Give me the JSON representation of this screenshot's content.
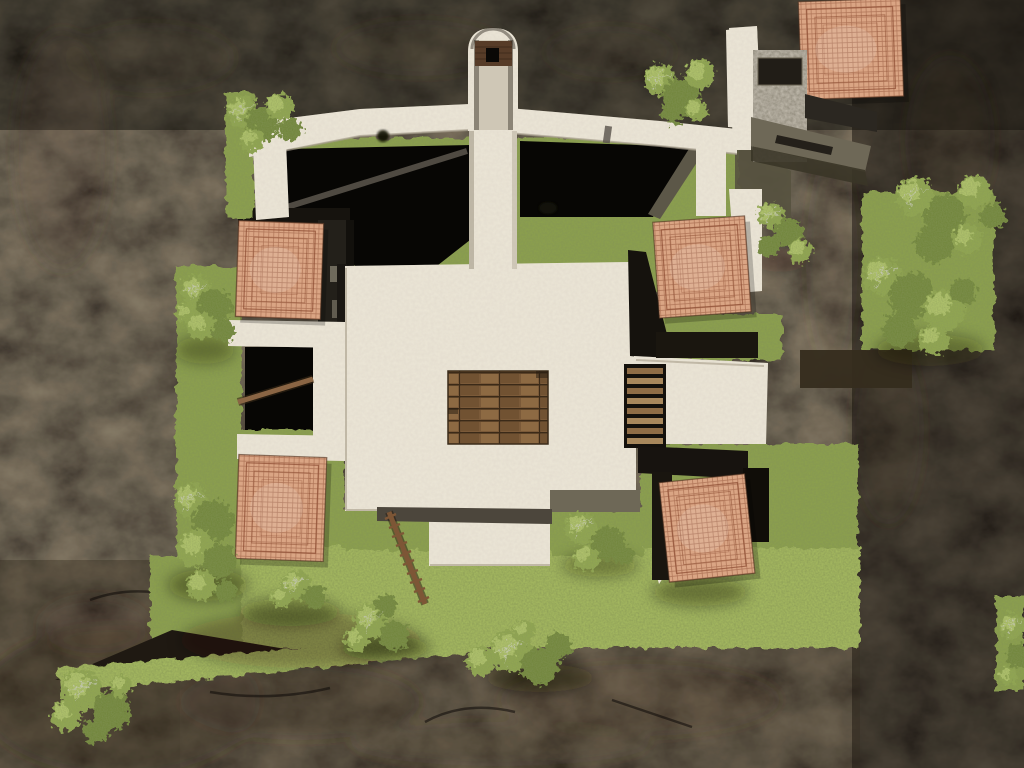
{
  "scene": {
    "type": "game-screenshot",
    "view": "top-down-aerial",
    "description": "Overhead view of a walled stone courtyard compound with terracotta tiled roofs, central plaza, wooden platform and ladder, grass terraces, trees and surrounding dark rock cliffs"
  },
  "viewport": {
    "width": 1024,
    "height": 768
  },
  "palette": {
    "rock": "#1f1912",
    "rock_deep": "#0e0b07",
    "rock_warm": "#3a2f21",
    "rock_hi": "#564635",
    "grass": "#8da24e",
    "grass_hi": "#a9bd62",
    "grass_deep": "#5f7530",
    "stone": "#ece6d7",
    "stone_edge": "#b7ae9b",
    "pit": "#070604",
    "wall_dark": "#201c16",
    "concrete": "#8d8778",
    "olive": "#6e6857",
    "roof": "#daa584",
    "roof_line": "#8a4a30",
    "roof_edge": "#4a2d1c",
    "wood": "#7b5a39",
    "wood_dark": "#3b2a18",
    "wood_hi": "#8d6a43",
    "ladder": "#7d5636",
    "tree": "#93a951",
    "tree_hi": "#bccf74",
    "tree_deep": "#6e8438",
    "branch": "#d8d8d0"
  },
  "objects": {
    "terrain": "rocky cliff terrain",
    "courtyard": "courtyard interior with shadow pits",
    "plaza": "white stone plaza",
    "tower": "stone bell tower",
    "platform": "wooden plank platform",
    "slats": "wooden slat walkway",
    "ladder": "wooden ladder",
    "beam": "wooden beam",
    "building": "corner stone building",
    "walkway": "concrete walkway",
    "roofs": "terracotta tiled roofs",
    "trees": "trees and bushes",
    "grass": "grass terraces"
  },
  "roofs": [
    {
      "name": "roof-upper-left",
      "x": 237,
      "y": 222,
      "w": 85,
      "h": 96,
      "rot": 2
    },
    {
      "name": "roof-upper-right",
      "x": 656,
      "y": 219,
      "w": 92,
      "h": 96,
      "rot": -4
    },
    {
      "name": "roof-lower-left",
      "x": 237,
      "y": 456,
      "w": 88,
      "h": 104,
      "rot": 2
    },
    {
      "name": "roof-lower-right",
      "x": 664,
      "y": 478,
      "w": 86,
      "h": 100,
      "rot": -6
    },
    {
      "name": "roof-top-corner",
      "x": 800,
      "y": 0,
      "w": 102,
      "h": 98,
      "rot": -2
    }
  ],
  "trees": [
    {
      "name": "bush-top-wall",
      "blobs": [
        [
          243,
          112,
          16
        ],
        [
          262,
          124,
          17
        ],
        [
          279,
          107,
          14
        ],
        [
          290,
          130,
          12
        ],
        [
          252,
          140,
          12
        ]
      ]
    },
    {
      "name": "tree-top-center",
      "blobs": [
        [
          660,
          80,
          16
        ],
        [
          681,
          96,
          18
        ],
        [
          700,
          74,
          15
        ],
        [
          673,
          112,
          12
        ],
        [
          696,
          110,
          11
        ]
      ]
    },
    {
      "name": "tree-courtyard-right",
      "blobs": [
        [
          771,
          216,
          13
        ],
        [
          789,
          233,
          15
        ],
        [
          800,
          251,
          12
        ],
        [
          769,
          247,
          11
        ]
      ]
    },
    {
      "name": "tree-right-upper",
      "blobs": [
        [
          915,
          196,
          19
        ],
        [
          945,
          216,
          21
        ],
        [
          974,
          192,
          17
        ],
        [
          934,
          244,
          19
        ],
        [
          967,
          239,
          15
        ],
        [
          993,
          216,
          13
        ]
      ]
    },
    {
      "name": "tree-right-lower",
      "blobs": [
        [
          882,
          276,
          19
        ],
        [
          912,
          296,
          23
        ],
        [
          944,
          310,
          21
        ],
        [
          900,
          330,
          17
        ],
        [
          934,
          340,
          15
        ],
        [
          963,
          291,
          13
        ]
      ]
    },
    {
      "name": "tree-left-upper",
      "blobs": [
        [
          196,
          291,
          15
        ],
        [
          215,
          306,
          17
        ],
        [
          201,
          326,
          14
        ],
        [
          224,
          331,
          11
        ],
        [
          186,
          313,
          10
        ]
      ]
    },
    {
      "name": "tree-left-lower",
      "blobs": [
        [
          191,
          501,
          17
        ],
        [
          213,
          521,
          21
        ],
        [
          196,
          549,
          19
        ],
        [
          220,
          561,
          17
        ],
        [
          201,
          585,
          15
        ],
        [
          226,
          591,
          11
        ]
      ]
    },
    {
      "name": "tree-below-roof-c",
      "blobs": [
        [
          296,
          585,
          15
        ],
        [
          315,
          597,
          12
        ],
        [
          281,
          598,
          10
        ]
      ]
    },
    {
      "name": "tree-bottom-left-mid",
      "blobs": [
        [
          371,
          621,
          17
        ],
        [
          394,
          636,
          15
        ],
        [
          356,
          640,
          12
        ],
        [
          386,
          606,
          11
        ]
      ]
    },
    {
      "name": "tree-center-bottom",
      "blobs": [
        [
          581,
          528,
          16
        ],
        [
          608,
          543,
          17
        ],
        [
          586,
          558,
          13
        ],
        [
          624,
          555,
          10
        ]
      ]
    },
    {
      "name": "tree-bottom-center",
      "blobs": [
        [
          511,
          651,
          21
        ],
        [
          540,
          666,
          19
        ],
        [
          481,
          661,
          15
        ],
        [
          559,
          646,
          13
        ],
        [
          524,
          631,
          11
        ]
      ]
    },
    {
      "name": "tree-bottom-left-corner",
      "blobs": [
        [
          82,
          690,
          21
        ],
        [
          111,
          711,
          19
        ],
        [
          66,
          716,
          15
        ],
        [
          96,
          731,
          13
        ],
        [
          121,
          686,
          11
        ]
      ]
    },
    {
      "name": "tree-right-edge",
      "blobs": [
        [
          1012,
          626,
          13
        ],
        [
          1018,
          656,
          12
        ],
        [
          1008,
          676,
          9
        ]
      ]
    }
  ]
}
